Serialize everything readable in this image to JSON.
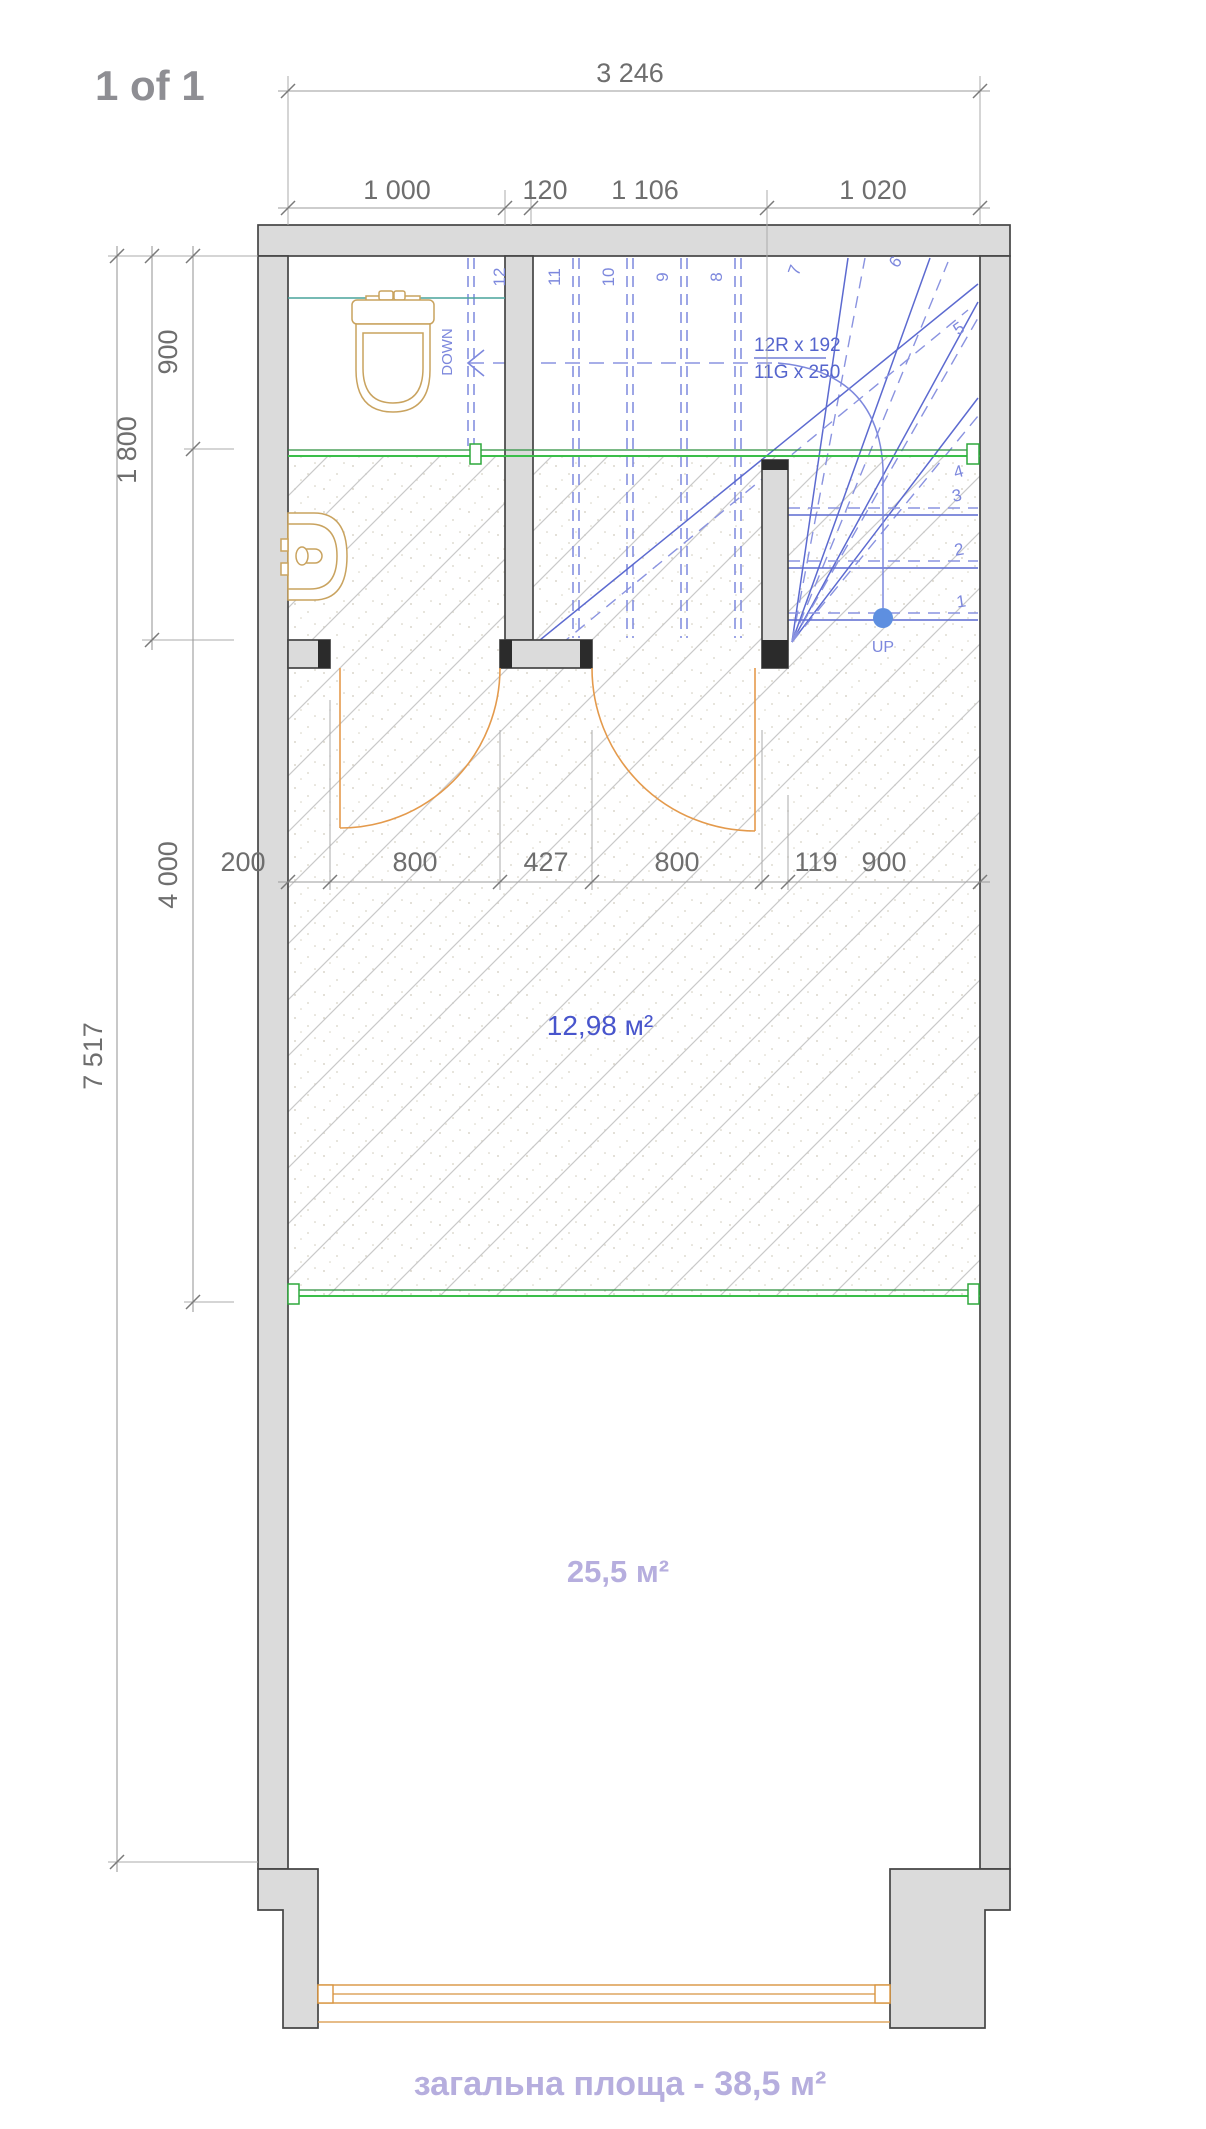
{
  "page": {
    "label": "1 of 1"
  },
  "dimensions": {
    "top_total": "3 246",
    "top_segments": [
      "1 000",
      "120",
      "1 106",
      "1 020"
    ],
    "left_total": "7 517",
    "left_segments": [
      "900",
      "1 800",
      "4 000"
    ],
    "middle_segments": [
      "200",
      "800",
      "427",
      "800",
      "119",
      "900"
    ]
  },
  "stairs": {
    "riser_annotation": "12R x 192",
    "going_annotation": "11G x 250",
    "down_label": "DOWN",
    "up_label": "UP",
    "step_numbers": [
      "1",
      "2",
      "3",
      "4",
      "5",
      "6",
      "7",
      "8",
      "9",
      "10",
      "11",
      "12"
    ]
  },
  "areas": {
    "hall": "12,98 м²",
    "living": "25,5 м²"
  },
  "footer": {
    "total_area": "загальна площа - 38,5 м²"
  },
  "colors": {
    "wall_fill": "#dbdbdb",
    "stair_blue": "#5c6ad0",
    "stair_dashed_blue": "#8a93e0",
    "partition_green": "#3bbf4a",
    "fixture_tan": "#c9a35f",
    "door_orange": "#e49a4c",
    "area_hall_text": "#4855cc",
    "area_living_text": "#b6aede",
    "dimension_text": "#6e6e6e",
    "page_label_text": "#8e8e93"
  }
}
